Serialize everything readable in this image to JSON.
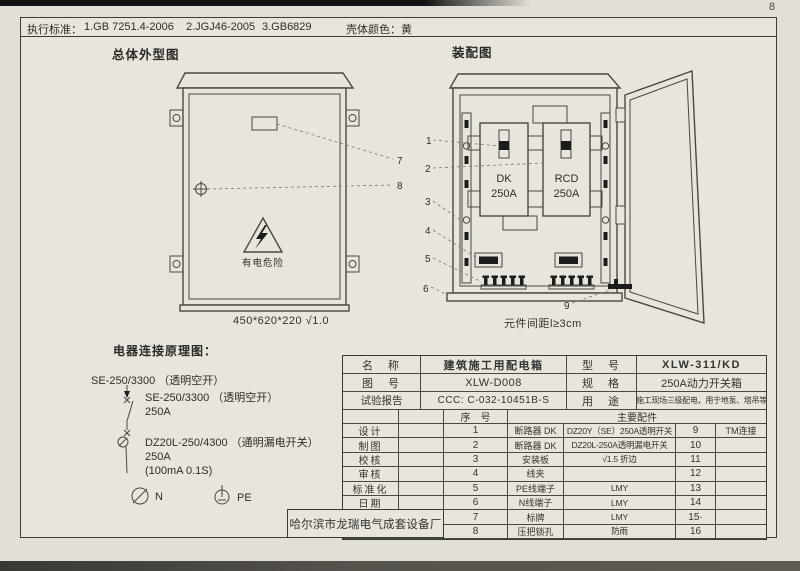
{
  "page": {
    "number": "8"
  },
  "header": {
    "standards_label": "执行标准：",
    "standard_1": "1.GB 7251.4-2006",
    "standard_2": "2.JGJ46-2005",
    "standard_3": "3.GB6829",
    "shell_color": "壳体颜色：黄"
  },
  "outline": {
    "title": "总体外型图",
    "warning": "有电危险",
    "dimensions": "450*620*220  √1.0",
    "callout_7": "7",
    "callout_8": "8"
  },
  "assembly": {
    "title": "装配图",
    "dk_name": "DK",
    "dk_rating": "250A",
    "rcd_name": "RCD",
    "rcd_rating": "250A",
    "note": "元件间距l≥3cm",
    "c1": "1",
    "c2": "2",
    "c3": "3",
    "c4": "4",
    "c5": "5",
    "c6": "6",
    "c9": "9"
  },
  "schematic": {
    "title": "电器连接原理图：",
    "incoming_label": "SE-250/3300 （透明空开）",
    "main_label": "SE-250/3300 （透明空开）",
    "main_rating": "250A",
    "rcd_label": "DZ20L-250/4300 （通明漏电开关）",
    "rcd_rating": "250A",
    "rcd_param": "(100mA 0.1S)",
    "n_label": "N",
    "pe_label": "PE"
  },
  "title_block": {
    "name_label": "名　称",
    "name_value": "建筑施工用配电箱",
    "model_label": "型　号",
    "model_value": "XLW-311/KD",
    "drawing_no_label": "图　号",
    "drawing_no_value": "XLW-D008",
    "spec_label": "规　格",
    "spec_value": "250A动力开关箱",
    "report_label": "试验报告",
    "report_value": "CCC: C-032-10451B-S",
    "use_label": "用　途",
    "use_value": "施工现场三级配电，用于地泵、塔吊等",
    "serial_header": "序　号",
    "parts_header": "主要配件",
    "rows": [
      {
        "role": "设计",
        "no": "1",
        "part": "断路器 DK",
        "spec": "DZ20Y（SE）250A透明开关",
        "no2": "9",
        "spec2": "TM连接"
      },
      {
        "role": "制图",
        "no": "2",
        "part": "断路器 DK",
        "spec": "DZ20L-250A透明漏电开关",
        "no2": "10",
        "spec2": ""
      },
      {
        "role": "校核",
        "no": "3",
        "part": "安装板",
        "spec": "√1.5 折边",
        "no2": "11",
        "spec2": ""
      },
      {
        "role": "审核",
        "no": "4",
        "part": "线夹",
        "spec": "",
        "no2": "12",
        "spec2": ""
      },
      {
        "role": "标准化",
        "no": "5",
        "part": "PE线端子",
        "spec": "LMY",
        "no2": "13",
        "spec2": ""
      },
      {
        "role": "日期",
        "no": "6",
        "part": "N线端子",
        "spec": "LMY",
        "no2": "14",
        "spec2": ""
      },
      {
        "role": "",
        "no": "7",
        "part": "标牌",
        "spec": "LMY",
        "no2": "15·",
        "spec2": ""
      },
      {
        "role": "",
        "no": "8",
        "part": "压把锁孔",
        "spec": "防雨",
        "no2": "16",
        "spec2": ""
      }
    ],
    "factory": "哈尔滨市龙瑞电气成套设备厂"
  }
}
